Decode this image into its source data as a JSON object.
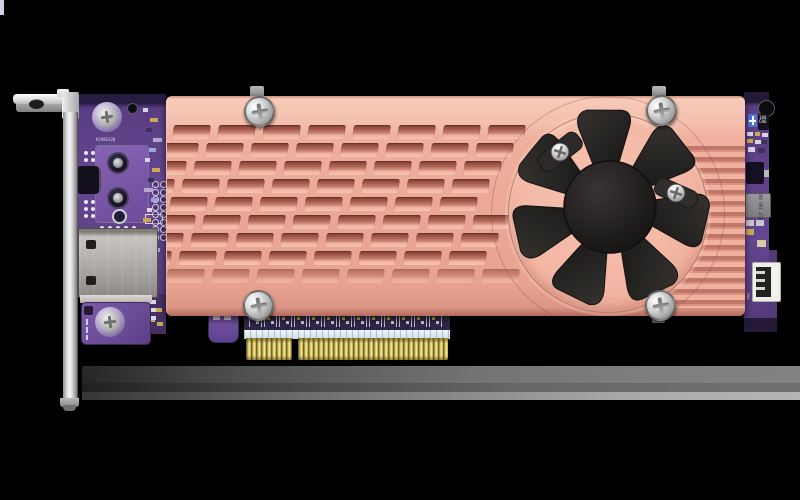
{
  "scene": {
    "type": "product-photo",
    "subject": "PCIe expansion card with copper heatsink, cooling fan, network port and low-profile bracket",
    "background": "#000000"
  },
  "palette": {
    "heatsink_top": "#f6c8b5",
    "heatsink_base": "#eeac99",
    "fin_shadow": "#8d4c40",
    "pcb_purple": "#5d3f85",
    "pcb_dark": "#241a38",
    "gold_fingers": "#d9c766",
    "bracket_silver": "#d9d9d9",
    "fan_black": "#232120",
    "port_gray": "#b2afac",
    "shadow_gray": "#7d7d7d"
  },
  "heatsink": {
    "fin_rows": 9,
    "screw_count": 4
  },
  "fan": {
    "blade_count": 7,
    "mount_screw_count": 2
  },
  "pcie_edge": {
    "segment_count": 2
  },
  "markings": {
    "silkscreen_left": "K298CA28",
    "chip_right": "100 CH6",
    "inductor_right": "417 100 081",
    "fan_header_label": "FN2"
  }
}
